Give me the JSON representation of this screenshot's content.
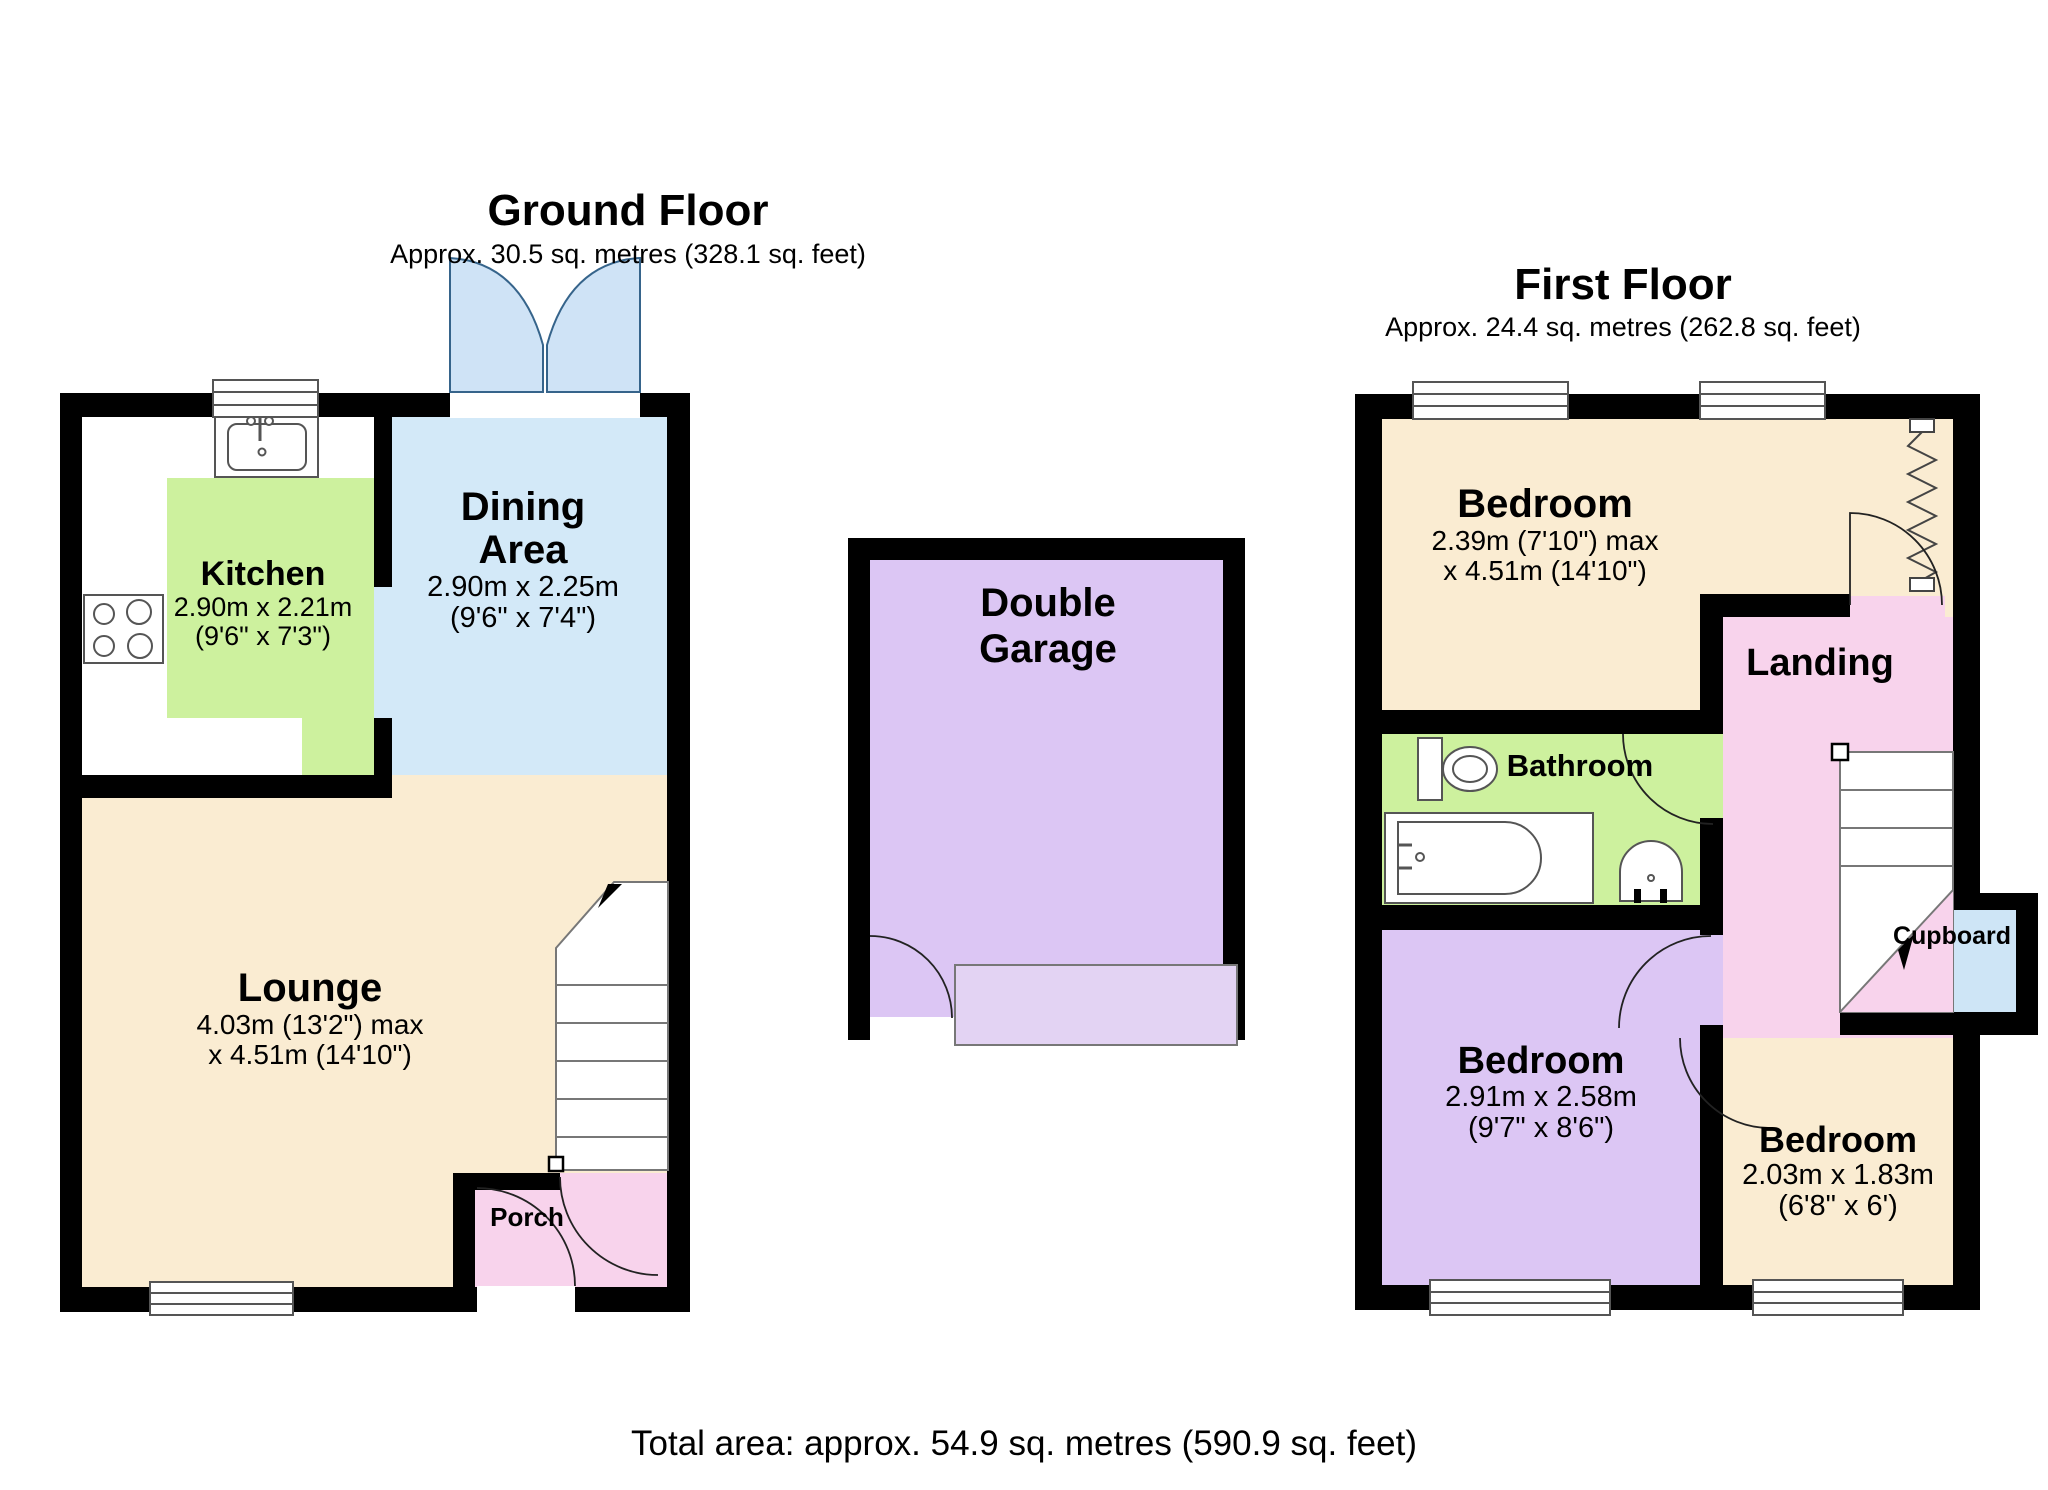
{
  "palette": {
    "wall": "#000000",
    "cream": "#FAECD2",
    "green": "#CDF19E",
    "dining_blue": "#D3E9F8",
    "purple": "#DCC6F4",
    "pink": "#F8D3EC",
    "cupboard_blue": "#CEE5F6",
    "petal_blue": "#CFE3F6",
    "garage_door": "#E3D3F3"
  },
  "ground_floor": {
    "title": "Ground Floor",
    "subtitle": "Approx. 30.5 sq. metres (328.1 sq. feet)",
    "rooms": {
      "kitchen": {
        "name": "Kitchen",
        "size_line1": "2.90m x 2.21m",
        "size_line2": "(9'6\" x 7'3\")"
      },
      "dining": {
        "name_line1": "Dining",
        "name_line2": "Area",
        "size_line1": "2.90m x 2.25m",
        "size_line2": "(9'6\" x 7'4\")"
      },
      "lounge": {
        "name": "Lounge",
        "size_line1": "4.03m (13'2\") max",
        "size_line2": "x 4.51m (14'10\")"
      },
      "porch": {
        "name": "Porch"
      }
    }
  },
  "garage": {
    "name_line1": "Double",
    "name_line2": "Garage"
  },
  "first_floor": {
    "title": "First Floor",
    "subtitle": "Approx. 24.4 sq. metres (262.8 sq. feet)",
    "rooms": {
      "bedroom_top": {
        "name": "Bedroom",
        "size_line1": "2.39m (7'10\") max",
        "size_line2": "x 4.51m (14'10\")"
      },
      "bathroom": {
        "name": "Bathroom"
      },
      "landing": {
        "name": "Landing"
      },
      "cupboard": {
        "name": "Cupboard"
      },
      "bedroom_left": {
        "name": "Bedroom",
        "size_line1": "2.91m x 2.58m",
        "size_line2": "(9'7\" x 8'6\")"
      },
      "bedroom_right": {
        "name": "Bedroom",
        "size_line1": "2.03m x 1.83m",
        "size_line2": "(6'8\" x 6')"
      }
    }
  },
  "footer": {
    "total_area": "Total area: approx. 54.9 sq. metres (590.9 sq. feet)"
  }
}
